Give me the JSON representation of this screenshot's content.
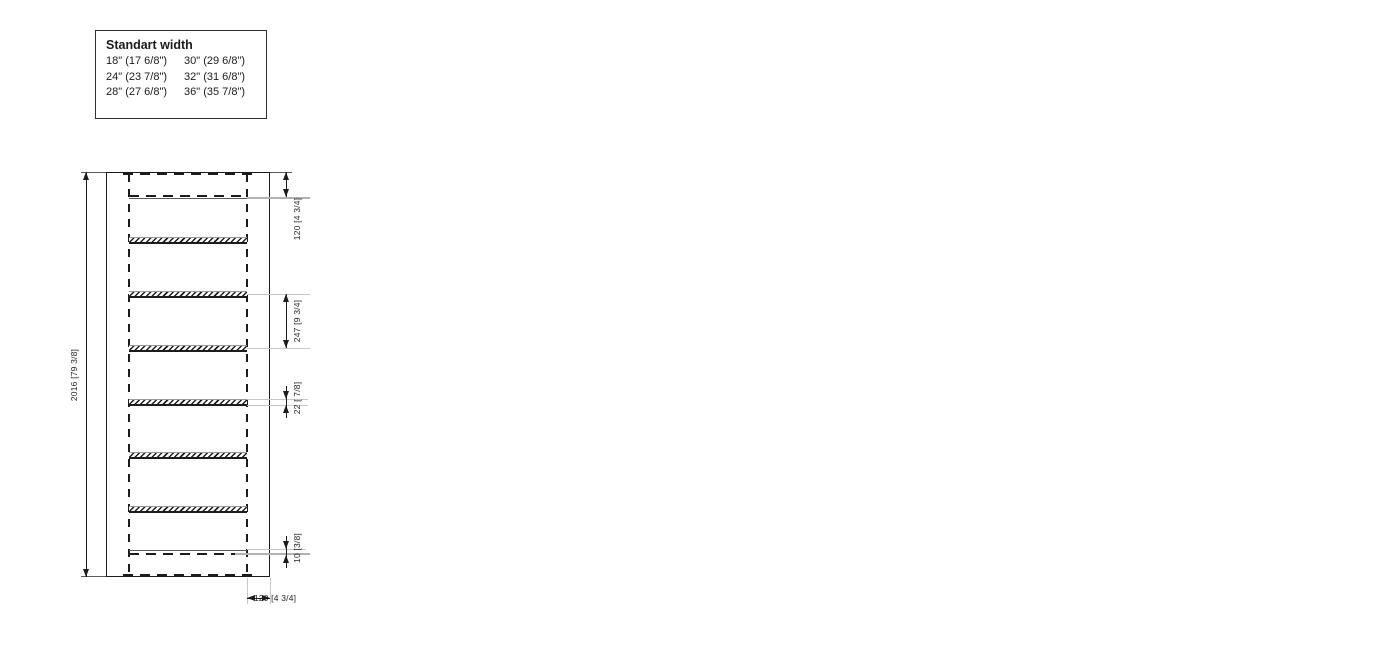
{
  "colors": {
    "line": "#1c1c1c",
    "thin": "#5a5a5a",
    "leader": "#c6c6c6",
    "leader_strong": "#b2b2b2",
    "text": "#1f1f1f",
    "background": "#ffffff"
  },
  "legend": {
    "title": "Standart width",
    "rows": [
      [
        "18\" (17 6/8\")",
        "30\" (29 6/8\")"
      ],
      [
        "24\" (23 7/8\")",
        "32\" (31 6/8\")"
      ],
      [
        "28\" (27 6/8\")",
        "36\" (35 7/8\")"
      ]
    ]
  },
  "drawings": [
    {
      "name": "frame-2016",
      "height_label": "2016 [79 3/8]",
      "top_offset_label": "120 [4 3/4]",
      "spacing_label": "247 [9 3/4]",
      "thickness_label": "22 [ 7/8]",
      "bottom_offset_label": "10 [3/8]",
      "stile_width_label": "120 [4 3/4]",
      "width_label": "w",
      "layout": {
        "x": 106,
        "width": 164,
        "rail": 23,
        "top": 172,
        "bottom": 577,
        "top_dash": 197,
        "bottom_dash": 554,
        "sill": true,
        "edge_dashes": true,
        "bars": [
          240,
          294,
          348,
          402,
          455,
          509
        ],
        "spacing_bars": [
          1,
          2
        ],
        "thickness_bar": 3,
        "bottom_dim": [
          549,
          555
        ],
        "dim_offset": 16,
        "label_offset": 27
      }
    },
    {
      "name": "frame-2114",
      "height_label": "2114 [83 1/4]",
      "top_offset_label": "120 [4 3/4]",
      "spacing_label": "247 [9 3/4]",
      "thickness_label": "22 [ 7/8]",
      "bottom_offset_label": "10 [3/8]",
      "stile_width_label": "120 [4 3/4]",
      "width_label": "w",
      "layout": {
        "x": 415,
        "width": 170,
        "rail": 25,
        "top": 128,
        "top_dash": 152,
        "bottom": 577,
        "bottom_dash": 553,
        "sill": true,
        "edge_dashes": false,
        "bars": [
          178,
          236,
          293,
          349,
          408,
          465,
          523
        ],
        "spacing_bars": [
          2,
          3
        ],
        "thickness_bar": 4,
        "bottom_dim": [
          548,
          554
        ],
        "dim_offset": 28,
        "label_offset": 39
      }
    },
    {
      "name": "frame-2350",
      "height_label": "2350 [92 1/2]",
      "top_offset_label": "120 [4 3/4]",
      "spacing_label": "247 [9 3/4]",
      "thickness_label": "22 [7/8]",
      "bottom_offset_label": "10 [3/8]",
      "stile_width_label": "120 [4 3/4]",
      "width_label": "w",
      "layout": {
        "x": 740,
        "width": 174,
        "rail": 25,
        "top": 66,
        "top_dash": 92,
        "bottom": 577,
        "bottom_dash": 550,
        "sill": true,
        "edge_dashes": false,
        "bars": [
          145,
          203,
          260,
          318,
          377,
          435,
          493
        ],
        "spacing_bars": [
          2,
          3
        ],
        "thickness_bar": 4,
        "bottom_dim": [
          545,
          551
        ],
        "dim_offset": 32,
        "label_offset": 43
      }
    },
    {
      "name": "frame-2419",
      "height_label": "2419 [95 1/4]",
      "top_offset_label": "120 [4 3/4]",
      "spacing_label": "247 [9 3/4]",
      "thickness_label": "22 [ 7/8]",
      "bottom_offset_label": "12,5 [1/2]",
      "stile_width_label": "120 [4 3/4]",
      "width_label": "w",
      "layout": {
        "x": 1073,
        "width": 179,
        "rail": 26,
        "top": 37,
        "top_dash": 63,
        "bottom": 577,
        "bottom_dash": 551,
        "sill": false,
        "edge_dashes": false,
        "bars": [
          67,
          127,
          187,
          247,
          305,
          366,
          424,
          484,
          545
        ],
        "spacing_bars": [
          3,
          4
        ],
        "thickness_bar": 5,
        "bottom_dim": [
          547,
          553
        ],
        "dim_offset": 38,
        "label_offset": 49
      }
    }
  ]
}
